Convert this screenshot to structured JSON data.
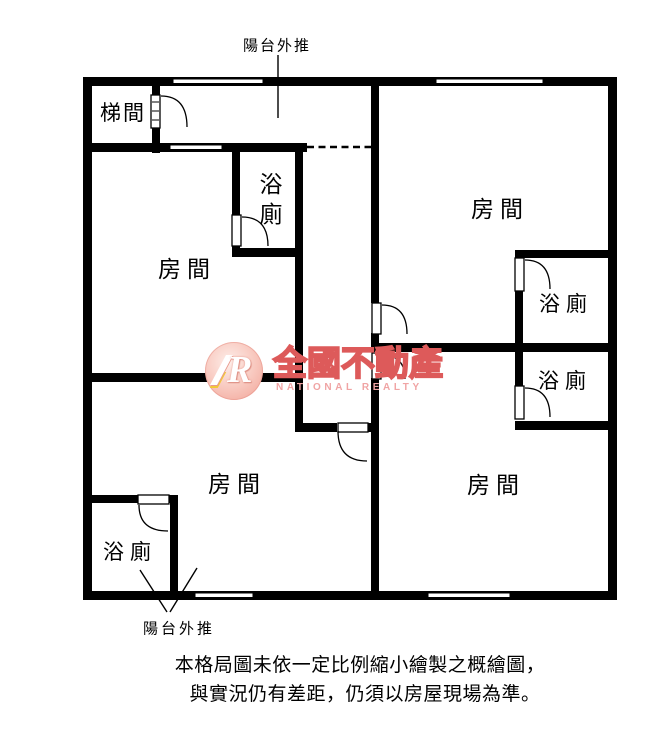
{
  "floorplan": {
    "labels": {
      "stairwell": "梯間",
      "bedroom": "房間",
      "bathroom": "浴廁",
      "balcony_pushout": "陽台外推"
    },
    "watermark": {
      "logo_letter": "R",
      "brand": "全國不動產",
      "brand_en": "NATIONAL REALTY",
      "brand_color": "#dd5a5a",
      "logo_pink": "#f1a194",
      "accent_yellow": "#f2c937"
    },
    "disclaimer": {
      "line1": "本格局圖未依一定比例縮小繪製之概繪圖，",
      "line2": "與實況仍有差距，仍須以房屋現場為準。"
    },
    "colors": {
      "wall": "#000000",
      "background": "#ffffff"
    }
  }
}
